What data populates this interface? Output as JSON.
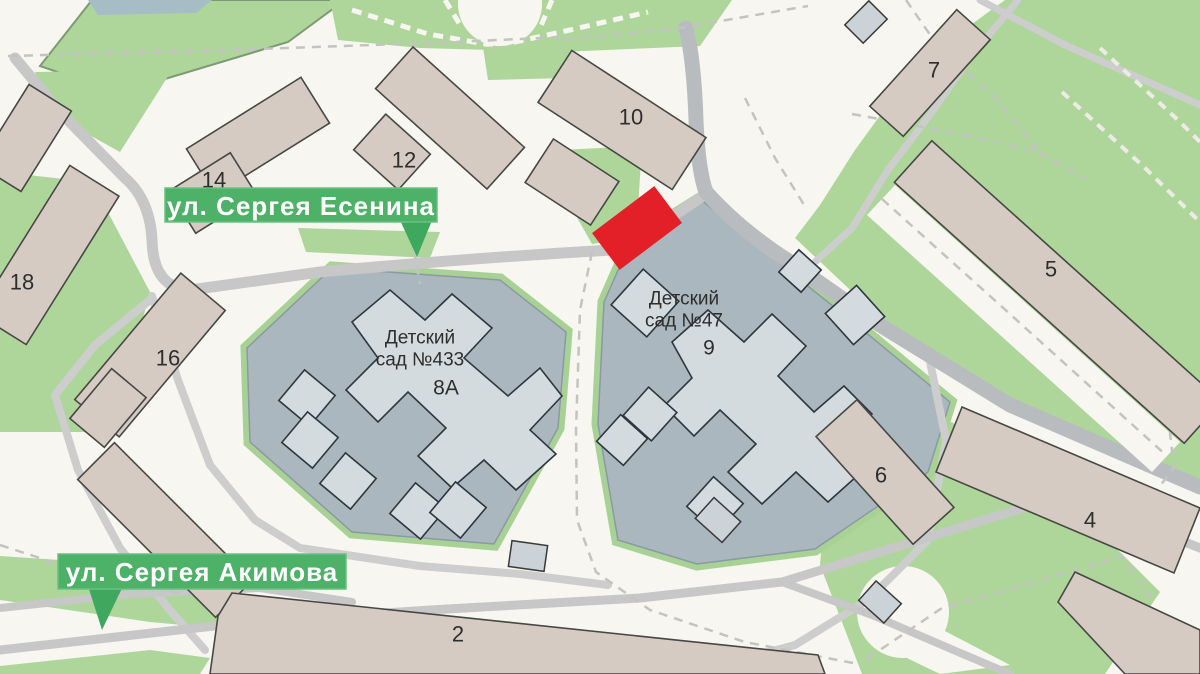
{
  "map": {
    "streets": [
      {
        "name": "ул. Сергея Есенина"
      },
      {
        "name": "ул. Сергея Акимова"
      }
    ],
    "kindergartens": [
      {
        "line1": "Детский",
        "line2": "сад №433",
        "building_label": "8А"
      },
      {
        "line1": "Детский",
        "line2": "сад №47",
        "building_label": "9"
      }
    ],
    "building_numbers": [
      "14",
      "12",
      "10",
      "7",
      "18",
      "16",
      "5",
      "6",
      "4",
      "2"
    ],
    "marker": {
      "shape": "rotated-rectangle",
      "meaning": "highlighted-location"
    },
    "colors": {
      "background": "#f7f6f1",
      "road_gray": "#c7c7c7",
      "main_road_gray": "#b9bcbe",
      "green_area": "#aed69b",
      "green_border": "#a8d295",
      "building_beige": "#d5cbc3",
      "kindergarten_lot": "#abb7bf",
      "kindergarten_building": "#d4dbdf",
      "small_building_gray": "#ccd3d8",
      "label_green": "#4db168",
      "pointer_green": "#3fa85f",
      "red": "#e32028"
    }
  }
}
